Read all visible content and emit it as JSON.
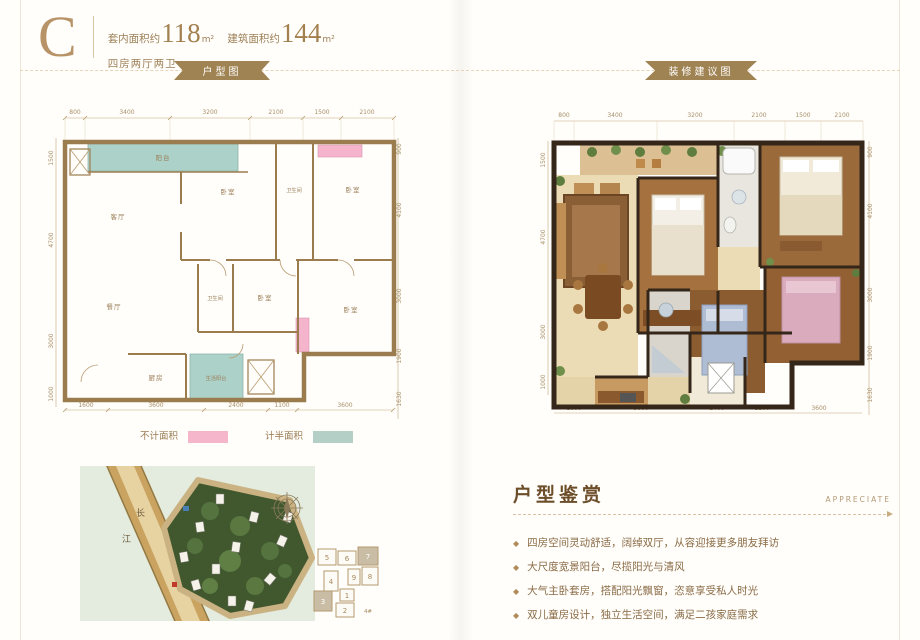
{
  "colors": {
    "accent_gold": "#ab8a58",
    "ribbon": "#a08353",
    "wall_tan": "#9b7c4e",
    "wall_dark": "#34271a",
    "teal_half_area": "#acd1c9",
    "pink_not_counted": "#f4b4cc",
    "text_brown": "#8a6b45"
  },
  "header": {
    "unit_letter": "C",
    "inner_area_label": "套内面积约",
    "inner_area_value": "118",
    "area_unit": "m²",
    "build_area_label": "建筑面积约",
    "build_area_value": "144",
    "layout_desc": "四房两厅两卫"
  },
  "tabs": {
    "floorplan": "户型图",
    "decoration": "装修建议图"
  },
  "floorplan": {
    "top_dims": [
      "800",
      "3400",
      "3200",
      "2100",
      "1500",
      "2100"
    ],
    "bottom_dims": [
      "1600",
      "3600",
      "2400",
      "1100",
      "3600"
    ],
    "left_dims": [
      "1500",
      "4700",
      "3000",
      "1000"
    ],
    "right_dims": [
      "900",
      "4100",
      "3000",
      "1900",
      "1630"
    ],
    "rooms": {
      "balcony": "阳台",
      "living": "客厅",
      "bedroom_a": "卧室",
      "bath_a": "卫生间",
      "bedroom_b": "卧室",
      "dining": "餐厅",
      "bath_b": "卫生间",
      "bedroom_c": "卧室",
      "bedroom_d": "卧室",
      "kitchen": "厨房",
      "utility_balcony": "生活阳台"
    }
  },
  "legend": {
    "not_counted": "不计面积",
    "half_counted": "计半面积"
  },
  "sitemap": {
    "river_char_1": "长",
    "river_char_2": "江",
    "keyplan": {
      "b1": "1",
      "b2": "2",
      "b3": "3",
      "b4": "4",
      "b5": "5",
      "b6": "6",
      "b7": "7",
      "b8": "8",
      "b9": "9",
      "label": "4#"
    }
  },
  "appreciate": {
    "title": "户型鉴赏",
    "subtitle": "APPRECIATE",
    "bullet_char": "◆",
    "bullets": [
      "四房空间灵动舒适，阔绰双厅，从容迎接更多朋友拜访",
      "大尺度宽景阳台，尽揽阳光与清风",
      "大气主卧套房，搭配阳光飘窗，恣意享受私人时光",
      "双儿童房设计，独立生活空间，满足二孩家庭需求"
    ]
  }
}
